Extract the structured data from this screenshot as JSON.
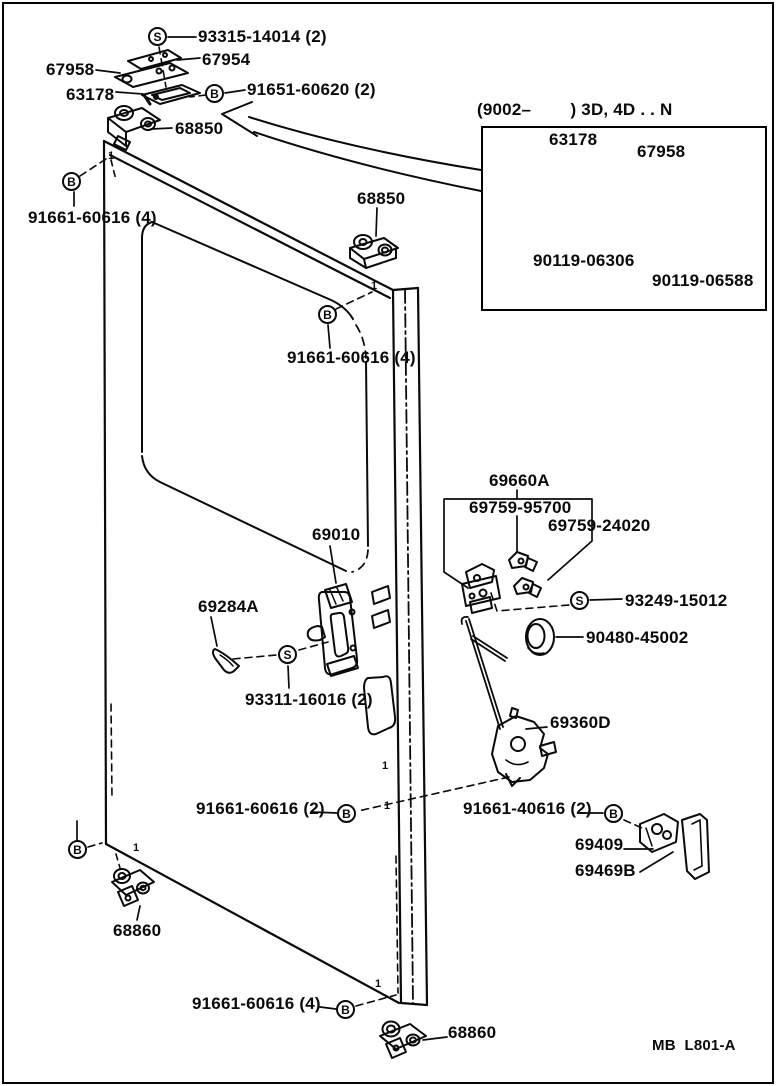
{
  "symbols": {
    "screw": "S",
    "bolt": "B"
  },
  "marks": {
    "ref1": "1"
  },
  "footer": {
    "code": "MB  L801-A"
  },
  "labels": {
    "p93315": "93315-14014 (2)",
    "p67954": "67954",
    "p67958": "67958",
    "p63178": "63178",
    "p91651": "91651-60620 (2)",
    "p68850_top": "68850",
    "p91661_60616_a": "91661-60616 (4)",
    "p68850_mid": "68850",
    "p91661_60616_b": "91661-60616 (4)",
    "p69660a": "69660A",
    "p69759_95700": "69759-95700",
    "p69759_24020": "69759-24020",
    "p93249": "93249-15012",
    "p90480": "90480-45002",
    "p69010": "69010",
    "p69284a": "69284A",
    "p93311": "93311-16016 (2)",
    "p69360d": "69360D",
    "p91661_60616_c": "91661-60616 (2)",
    "p91661_40616": "91661-40616 (2)",
    "p69409": "69409",
    "p69469b": "69469B",
    "p68860_left": "68860",
    "p91661_60616_d": "91661-60616 (4)",
    "p91661_60616_e": "91661-60616 (4)",
    "p68860_bottom": "68860"
  },
  "inset": {
    "title": "(9002–        ) 3D, 4D . . N",
    "labels": {
      "p63178": "63178",
      "p67958": "67958",
      "p90119_06306": "90119-06306",
      "p90119_06588": "90119-06588"
    }
  }
}
